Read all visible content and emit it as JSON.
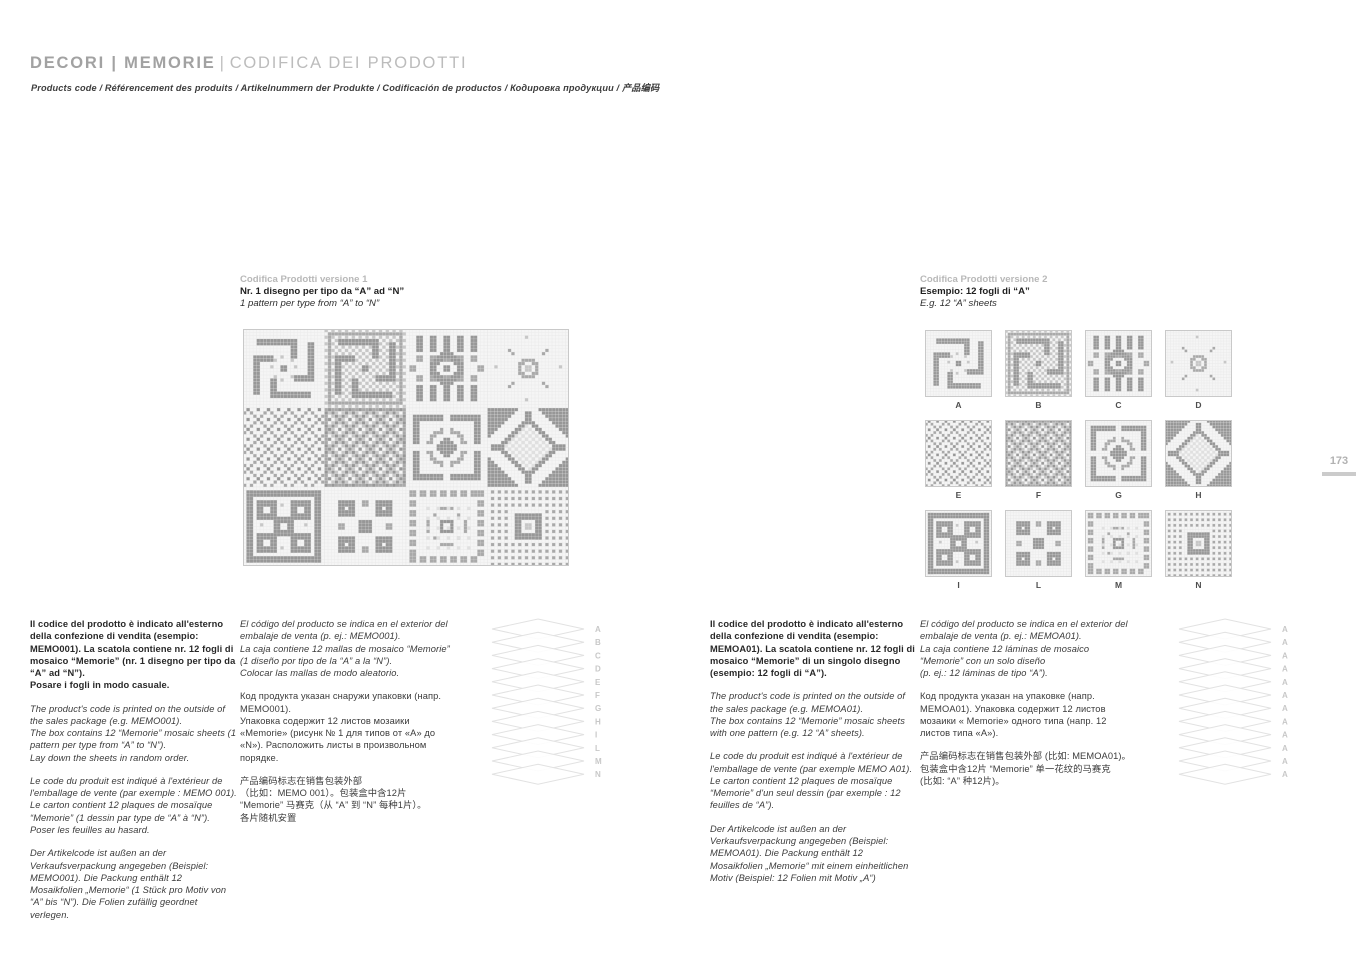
{
  "header": {
    "title_primary": "DECORI | MEMORIE",
    "title_separator": "|",
    "title_secondary": "CODIFICA DEI PRODOTTI",
    "subtitle": "Products code  / Référencement des produits  / Artikelnummern der Produkte  / Codificación de productos  / Кодировка продукции  / 产品编码"
  },
  "page_number": "173",
  "version1": {
    "kicker": "Codifica Prodotti versione 1",
    "title": "Nr. 1 disegno per tipo da “A” ad “N”",
    "subtitle": "1 pattern per type from “A” to “N”"
  },
  "version2": {
    "kicker": "Codifica Prodotti versione 2",
    "title": "Esempio: 12 fogli di “A”",
    "subtitle": "E.g. 12 “A” sheets"
  },
  "tiles": {
    "labels": [
      "A",
      "B",
      "C",
      "D",
      "E",
      "F",
      "G",
      "H",
      "I",
      "L",
      "M",
      "N"
    ]
  },
  "stacks": {
    "v1": {
      "labels": [
        "A",
        "B",
        "C",
        "D",
        "E",
        "F",
        "G",
        "H",
        "I",
        "L",
        "M",
        "N"
      ]
    },
    "v2": {
      "labels": [
        "A",
        "A",
        "A",
        "A",
        "A",
        "A",
        "A",
        "A",
        "A",
        "A",
        "A",
        "A"
      ]
    }
  },
  "columns": {
    "v1a": [
      {
        "lang": "it",
        "style": "b",
        "text": "Il codice del prodotto è indicato all'esterno della confezione di vendita (esempio: MEMO001). La scatola contiene nr. 12 fogli di mosaico “Memorie” (nr. 1 disegno per tipo da “A” ad “N”).\nPosare i fogli in modo casuale."
      },
      {
        "lang": "en",
        "style": "i",
        "text": "The product's code is printed on the outside of the sales package (e.g. MEMO001).\nThe box contains 12 “Memorie” mosaic sheets (1 pattern per type from “A” to “N”).\nLay down the sheets in random order."
      },
      {
        "lang": "fr",
        "style": "i",
        "text": "Le code du produit est indiqué à l'extérieur de l'emballage de vente (par exemple : MEMO 001). Le carton contient 12 plaques de mosaïque “Memorie” (1 dessin par type de “A” à “N”).  Poser les feuilles au hasard."
      },
      {
        "lang": "de",
        "style": "i",
        "text": "Der Artikelcode ist außen an der Verkaufsverpackung angegeben (Beispiel: MEMO001). Die Packung enthält 12 Mosaikfolien „Memorie“ (1 Stück pro Motiv von “A” bis “N”).  Die Folien zufällig geordnet verlegen."
      }
    ],
    "v1b": [
      {
        "lang": "es",
        "style": "i",
        "text": " El código del producto se indica en el exterior del embalaje de venta (p. ej.: MEMO001).\nLa caja contiene 12 mallas de mosaico “Memorie” (1 diseño por tipo de la “A” a la “N”).\nColocar las mallas de modo aleatorio."
      },
      {
        "lang": "ru",
        "style": "n",
        "text": "Код продукта указан снаружи упаковки (напр. MEMO001).\nУпаковка содержит 12 листов мозаики «Memorie» (рисунк № 1 для типов от «А» до «N»). Расположить листы в произвольном порядке."
      },
      {
        "lang": "zh",
        "style": "n",
        "text": "产品编码标志在销售包装外部\n（比如：MEMO 001）。包装盒中含12片 “Memorie” 马赛克（从 “A” 到 “N” 每种1片）。\n各片随机安置"
      }
    ],
    "v2a": [
      {
        "lang": "it",
        "style": "b",
        "text": "Il codice del prodotto è indicato all'esterno della confezione di vendita (esempio: MEMOA01). La scatola contiene nr. 12 fogli di mosaico “Memorie” di un singolo disegno (esempio: 12 fogli di “A”)."
      },
      {
        "lang": "en",
        "style": "i",
        "text": "The product's code is printed on the outside of the sales package (e.g. MEMOA01).\nThe box contains 12 “Memorie” mosaic sheets with one pattern (e.g. 12 “A” sheets)."
      },
      {
        "lang": "fr",
        "style": "i",
        "text": "Le code du produit est indiqué à l'extérieur de l'emballage de vente (par exemple MEMO A01).\nLe carton contient 12 plaques de mosaïque “Memorie” d'un seul dessin (par exemple : 12 feuilles de “A”)."
      },
      {
        "lang": "de",
        "style": "i",
        "text": "Der Artikelcode ist außen an der Verkaufsverpackung angegeben (Beispiel: MEMOA01). Die Packung enthält 12 Mosaikfolien „Memorie“ mit einem einheitlichen Motiv (Beispiel: 12 Folien mit Motiv „A“)"
      }
    ],
    "v2b": [
      {
        "lang": "es",
        "style": "i",
        "text": "El código del producto se indica en el exterior del embalaje de venta (p. ej.: MEMOA01).\nLa caja contiene 12 láminas de mosaico “Memorie” con un solo diseño\n(p. ej.: 12 láminas de tipo “A”)."
      },
      {
        "lang": "ru",
        "style": "n",
        "text": "Код продукта указан на упаковке (напр. MEMOA01). Упаковка содержит 12 листов мозаики « Memorie» одного типа (напр. 12 листов типа «А»)."
      },
      {
        "lang": "zh",
        "style": "n",
        "text": "产品编码标志在销售包装外部 (比如: MEMOA01)。\n包装盒中含12片 “Memorie” 单一花纹的马赛克\n(比如: “A” 种12片)。"
      }
    ]
  },
  "colors": {
    "accent_gray": "#a2a2a2",
    "pattern_dark": "#979797",
    "pattern_mid": "#c6c6c6",
    "page_bg": "#ffffff"
  }
}
